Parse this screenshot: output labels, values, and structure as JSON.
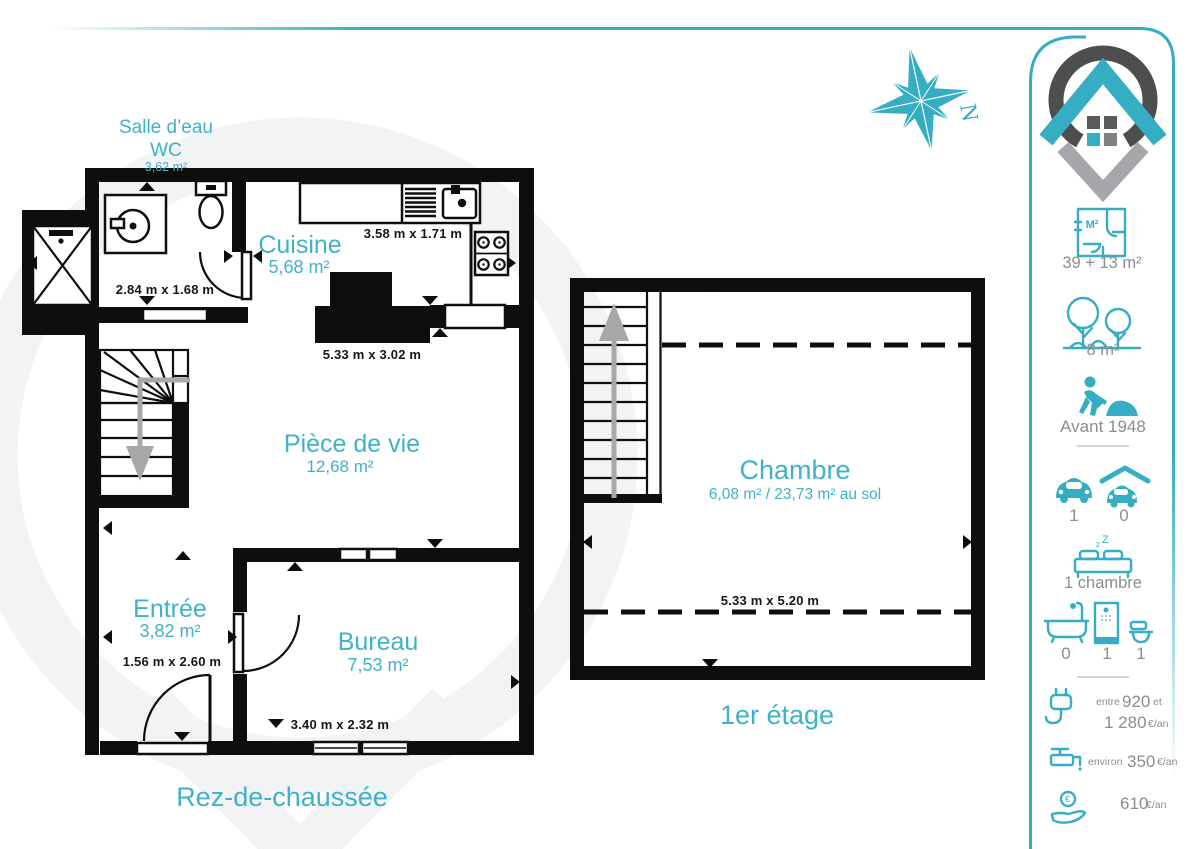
{
  "compass": {
    "north": "N"
  },
  "ground_floor": {
    "title": "Rez-de-chaussée",
    "salle_deau": {
      "name": "Salle d’eau",
      "name_2": "WC",
      "area": "3,62 m²",
      "dim": "2.84 m x 1.68 m"
    },
    "cuisine": {
      "name": "Cuisine",
      "area": "5,68 m²",
      "dim_top": "3.58 m x 1.71 m",
      "dim_bottom": "5.33 m x 3.02 m"
    },
    "piece_de_vie": {
      "name": "Pièce de vie",
      "area": "12,68 m²"
    },
    "entree": {
      "name": "Entrée",
      "area": "3,82 m²",
      "dim": "1.56 m x 2.60 m"
    },
    "bureau": {
      "name": "Bureau",
      "area": "7,53 m²",
      "dim": "3.40 m x 2.32 m"
    }
  },
  "first_floor": {
    "title": "1er étage",
    "chambre": {
      "name": "Chambre",
      "area": "6,08 m² / 23,73 m² au sol",
      "dim": "5.33 m x 5.20 m"
    }
  },
  "sidebar": {
    "surface": {
      "icon_label": "M²",
      "value": "39 + 13 m²"
    },
    "garden": {
      "value": "8 m²"
    },
    "construction": {
      "value": "Avant 1948"
    },
    "parking": {
      "outdoor": "1",
      "covered": "0"
    },
    "bedrooms": {
      "zz_small": "z",
      "zz_large": "Z",
      "value": "1 chambre"
    },
    "bathrooms": {
      "bathtub": "0",
      "shower": "1",
      "toilet": "1"
    },
    "energy": {
      "prefix": "entre",
      "value_low": "920",
      "conj": "et",
      "value_high": "1 280",
      "unit": "€/an"
    },
    "water": {
      "prefix": "environ",
      "value": "350",
      "unit": "€/an"
    },
    "tax": {
      "value": "610",
      "unit": "€/an",
      "coin": "€"
    }
  },
  "colors": {
    "teal": "#35ADC3",
    "teal_text": "#3FB2C7",
    "wall": "#0E0E0E",
    "gray_text": "#8B8D90",
    "logo_dark": "#4D4E50",
    "logo_gray": "#A5A7AA",
    "arrow_gray": "#A8A8A8"
  }
}
